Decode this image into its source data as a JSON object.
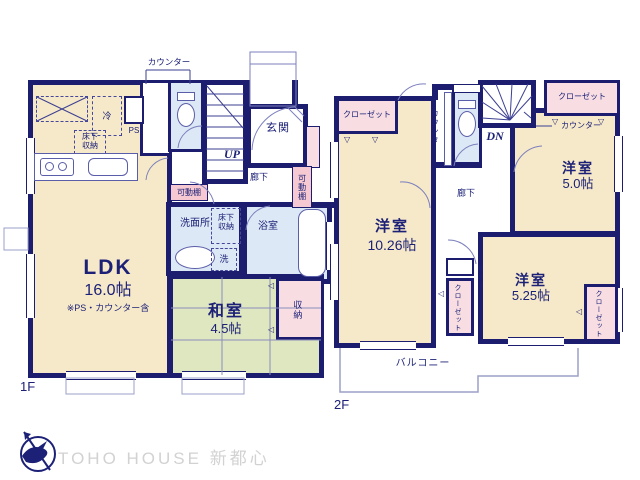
{
  "plan_title": "floor-plan",
  "colors": {
    "wall": "#1c1d6e",
    "room_beige": "#f6e9c9",
    "tatami_green": "#dfe7c1",
    "closet_pink": "#f8dee3",
    "shelf_pink": "#f6c9d2",
    "wet_blue": "#dce8f5",
    "text_navy": "#1c2177",
    "logo_gray": "#d2d2d2"
  },
  "floor1": {
    "label": "1F",
    "ldk": {
      "name": "LDK",
      "size": "16.0帖",
      "note": "※PS・カウンター含"
    },
    "washitsu": {
      "name": "和室",
      "size": "4.5帖"
    },
    "genkan": "玄関",
    "rouka": "廊下",
    "senmenjo": "洗面所",
    "yokushitsu": "浴室",
    "shuunou": "収納",
    "yukashita_kitchen": "床下収納",
    "yukashita_wash": "床下収納",
    "sen": "洗",
    "rei": "冷",
    "ps": "PS",
    "counter": "カウンター",
    "kadoudana1": "可動棚",
    "kadoudana2": "可動棚",
    "up": "UP"
  },
  "floor2": {
    "label": "2F",
    "room_a": {
      "name": "洋室",
      "size": "10.26帖"
    },
    "room_b": {
      "name": "洋室",
      "size": "5.0帖"
    },
    "room_c": {
      "name": "洋室",
      "size": "5.25帖"
    },
    "closet_nw": "クローゼット",
    "closet_ne": "クローゼット",
    "closet_mid": "クローゼット",
    "closet_se": "クローゼット",
    "counter_v": "カウンター",
    "counter_h": "カウンター",
    "rouka": "廊下",
    "dn": "DN",
    "eps": "EPS",
    "balcony": "バルコニー"
  },
  "symbols": {
    "door_down": "▽",
    "door_left": "◁"
  },
  "footer": {
    "brand": "TOHO HOUSE 新都心"
  }
}
